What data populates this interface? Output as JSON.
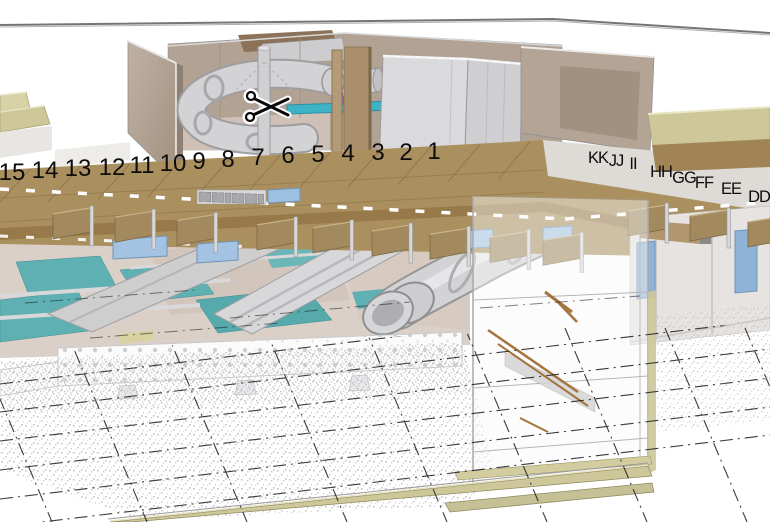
{
  "viewport": {
    "description": "3D sectioned building model viewport (pool facility with waterslides), section-cut view with structural grid annotations",
    "width": 770,
    "height": 522
  },
  "section_grid": {
    "numbers": [
      {
        "label": "15",
        "x": 12,
        "y": 172
      },
      {
        "label": "14",
        "x": 45,
        "y": 170
      },
      {
        "label": "13",
        "x": 78,
        "y": 168
      },
      {
        "label": "12",
        "x": 112,
        "y": 167
      },
      {
        "label": "11",
        "x": 142,
        "y": 165
      },
      {
        "label": "10",
        "x": 173,
        "y": 163
      },
      {
        "label": "9",
        "x": 199,
        "y": 161
      },
      {
        "label": "8",
        "x": 228,
        "y": 159
      },
      {
        "label": "7",
        "x": 258,
        "y": 157
      },
      {
        "label": "6",
        "x": 288,
        "y": 155
      },
      {
        "label": "5",
        "x": 318,
        "y": 154
      },
      {
        "label": "4",
        "x": 348,
        "y": 153
      },
      {
        "label": "3",
        "x": 378,
        "y": 152
      },
      {
        "label": "2",
        "x": 406,
        "y": 152
      },
      {
        "label": "1",
        "x": 434,
        "y": 151
      }
    ],
    "letters": [
      {
        "label": "KK",
        "x": 598,
        "y": 157
      },
      {
        "label": "JJ",
        "x": 616,
        "y": 160
      },
      {
        "label": "II",
        "x": 633,
        "y": 163
      },
      {
        "label": "HH",
        "x": 661,
        "y": 171
      },
      {
        "label": "GG",
        "x": 684,
        "y": 177
      },
      {
        "label": "FF",
        "x": 704,
        "y": 182
      },
      {
        "label": "EE",
        "x": 731,
        "y": 188
      },
      {
        "label": "DD",
        "x": 759,
        "y": 196
      }
    ]
  },
  "cursor": {
    "icon": "scissors-section-cut-cursor",
    "x": 268,
    "y": 107
  },
  "palette": {
    "wall_taupe": "#b4a496",
    "back_wall": "#b1a294",
    "roof_wood": "#ab905f",
    "fascia_brown": "#97794a",
    "beam_stub": "#a28a5e",
    "khaki_slab": "#cdc79a",
    "slide_gray": "#d3d3d5",
    "pool_teal": "#5fb0b2",
    "window_blue": "#a4c3e2",
    "duct_cyan": "#3fb3c6",
    "accent_purple": "#8e64c9",
    "handrail_brown": "#a4743c",
    "equipment_box_gray": "#dadadc",
    "label_ink": "#0d0d0d"
  }
}
